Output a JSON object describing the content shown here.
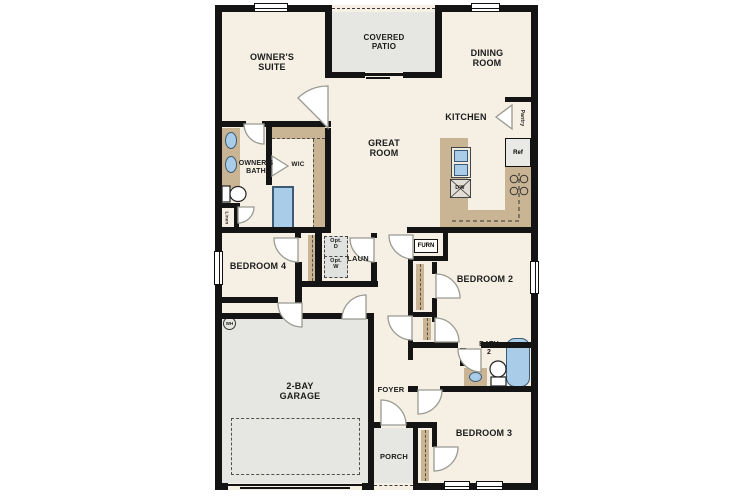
{
  "labels": {
    "owners_suite": "OWNER'S\nSUITE",
    "covered_patio": "COVERED\nPATIO",
    "dining_room": "DINING\nROOM",
    "kitchen": "KITCHEN",
    "great_room": "GREAT\nROOM",
    "owners_bath": "OWNER'S\nBATH",
    "wic": "WIC",
    "pantry": "Pantry",
    "ref": "Ref",
    "dw": "DW",
    "linen": "Linen",
    "bedroom4": "BEDROOM 4",
    "laundry": "LAUN",
    "opt_dryer": "Opt.\nD",
    "opt_washer": "Opt.\nW",
    "furnace": "FURN",
    "bedroom2": "BEDROOM 2",
    "bath2": "BATH\n2",
    "bedroom3": "BEDROOM 3",
    "garage": "2-BAY\nGARAGE",
    "foyer": "FOYER",
    "porch": "PORCH",
    "water_heater": "WH"
  },
  "colors": {
    "wall": "#141414",
    "floor": "#f5efe4",
    "exterior_gray": "#e6e6e2",
    "cabinet_tan": "#c9b494",
    "fixture_blue": "#a9cde9"
  }
}
